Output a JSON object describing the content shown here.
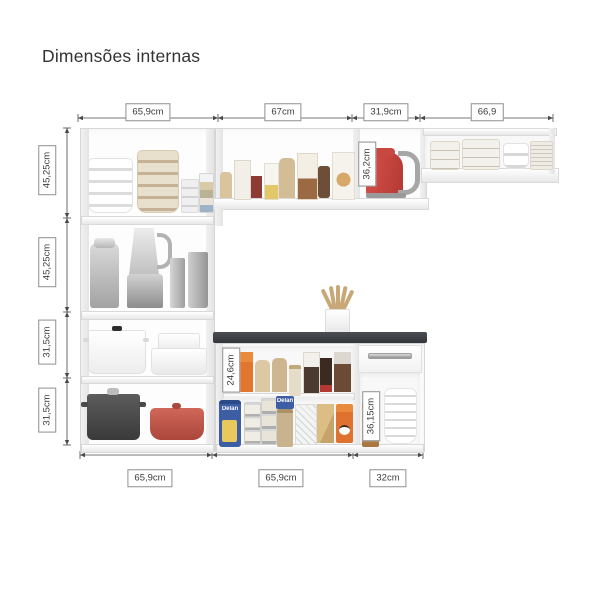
{
  "title": "Dimensões internas",
  "dims": {
    "top": [
      "65,9cm",
      "67cm",
      "31,9cm",
      "66,9"
    ],
    "left": [
      "45,25cm",
      "45,25cm",
      "31,5cm",
      "31,5cm"
    ],
    "bottom": [
      "65,9cm",
      "65,9cm",
      "32cm"
    ],
    "internal": {
      "upper_cabinet": "36,2cm",
      "counter_upper": "24,6cm",
      "counter_lower": "36,15cm"
    }
  },
  "brands": {
    "pasta_bag": "Delan",
    "pasta_pack": "Delan"
  },
  "colors": {
    "countertop": "#3a3d40",
    "kettle_red": "#c9453d",
    "dutch_oven_red": "#bf5a4c",
    "pasta_bag_blue": "#3d5ea5",
    "coffee_can_orange": "#e0722f",
    "dimension_line": "#4a4a4a",
    "title_text": "#333333"
  },
  "scene": {
    "left_cabinet": [
      "white-bowls-stack",
      "beige-bowls-stack",
      "glass-cups-stack",
      "striped-cups-stack",
      "juicer",
      "blender",
      "metal-canisters",
      "white-stockpot",
      "white-pots-stack",
      "black-stockpot",
      "red-dutch-oven"
    ],
    "upper_middle_cabinet": [
      "pantry-boxes-row"
    ],
    "upper_right_compartment": [
      "red-kettle"
    ],
    "wall_shelf": [
      "patterned-cups",
      "white-bowls",
      "patterned-plates"
    ],
    "counter_unit": [
      "utensil-crock-with-spoons",
      "pantry-boxes",
      "pasta-bags",
      "canned-goods",
      "drawer",
      "brown-canister",
      "white-bowls-stack"
    ]
  }
}
